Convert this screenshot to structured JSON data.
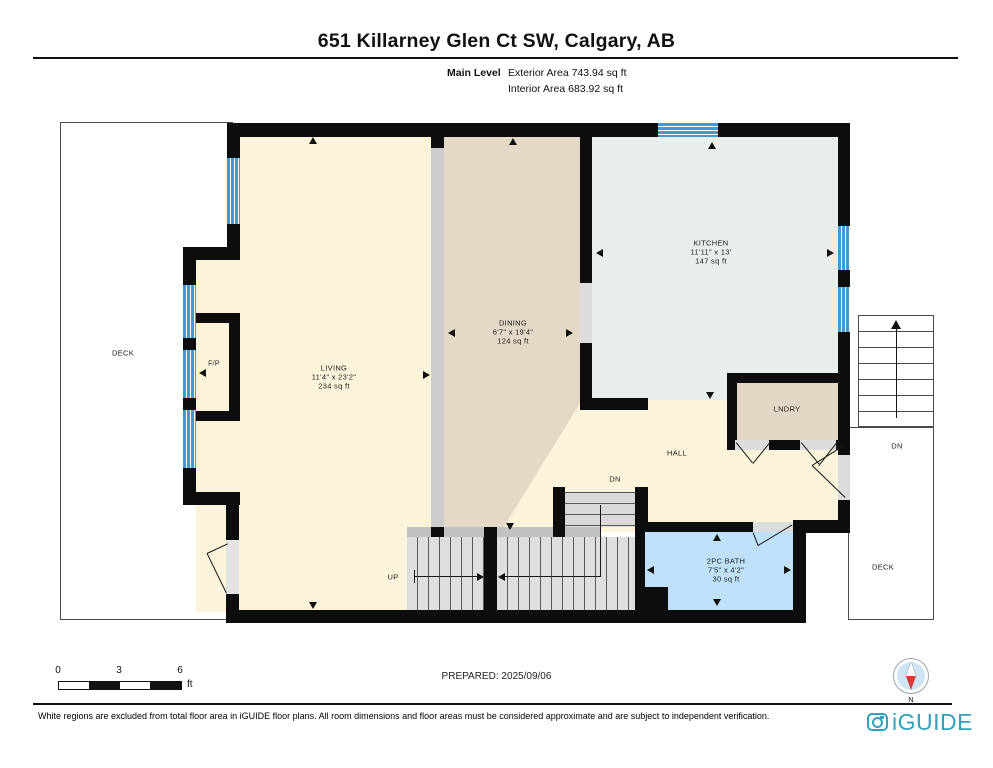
{
  "header": {
    "title": "651 Killarney Glen Ct SW, Calgary, AB",
    "level_label": "Main Level",
    "exterior_area": "Exterior Area 743.94 sq ft",
    "interior_area": "Interior Area 683.92 sq ft"
  },
  "rooms": {
    "living": {
      "name": "LIVING",
      "dims": "11'4\" x 23'2\"",
      "area": "234 sq ft"
    },
    "dining": {
      "name": "DINING",
      "dims": "6'7\" x 19'4\"",
      "area": "124 sq ft"
    },
    "kitchen": {
      "name": "KITCHEN",
      "dims": "11'11\" x 13'",
      "area": "147 sq ft"
    },
    "bath": {
      "name": "2PC BATH",
      "dims": "7'5\" x 4'2\"",
      "area": "30 sq ft"
    },
    "laundry": {
      "name": "LNDRY"
    },
    "hall": {
      "name": "HALL"
    },
    "fireplace": {
      "name": "F/P"
    },
    "deck_left": {
      "name": "DECK"
    },
    "deck_right": {
      "name": "DECK"
    }
  },
  "stairs": {
    "up": "UP",
    "down_interior": "DN",
    "down_exterior": "DN"
  },
  "scale_bar": {
    "ticks": [
      "0",
      "3",
      "6"
    ],
    "unit": "ft"
  },
  "footer": {
    "prepared": "PREPARED: 2025/09/06",
    "disclaimer": "White regions are excluded from total floor area in iGUIDE floor plans. All room dimensions and floor areas must be considered approximate and are subject to independent verification.",
    "brand": "iGUIDE",
    "compass_north": "N"
  },
  "colors": {
    "wall": "#0d0d0d",
    "window_blue": "#3E99D4",
    "living_floor": "#FBF4DB",
    "dining_floor": "#E3D9C6",
    "kitchen_floor": "#E8EEE9",
    "bath_floor": "#BEE1F8",
    "laundry_floor": "#E2D7C5",
    "stair_gray": "#DEDEDE",
    "brand_teal": "#2FA2BC",
    "compass_red": "#D73A32"
  }
}
